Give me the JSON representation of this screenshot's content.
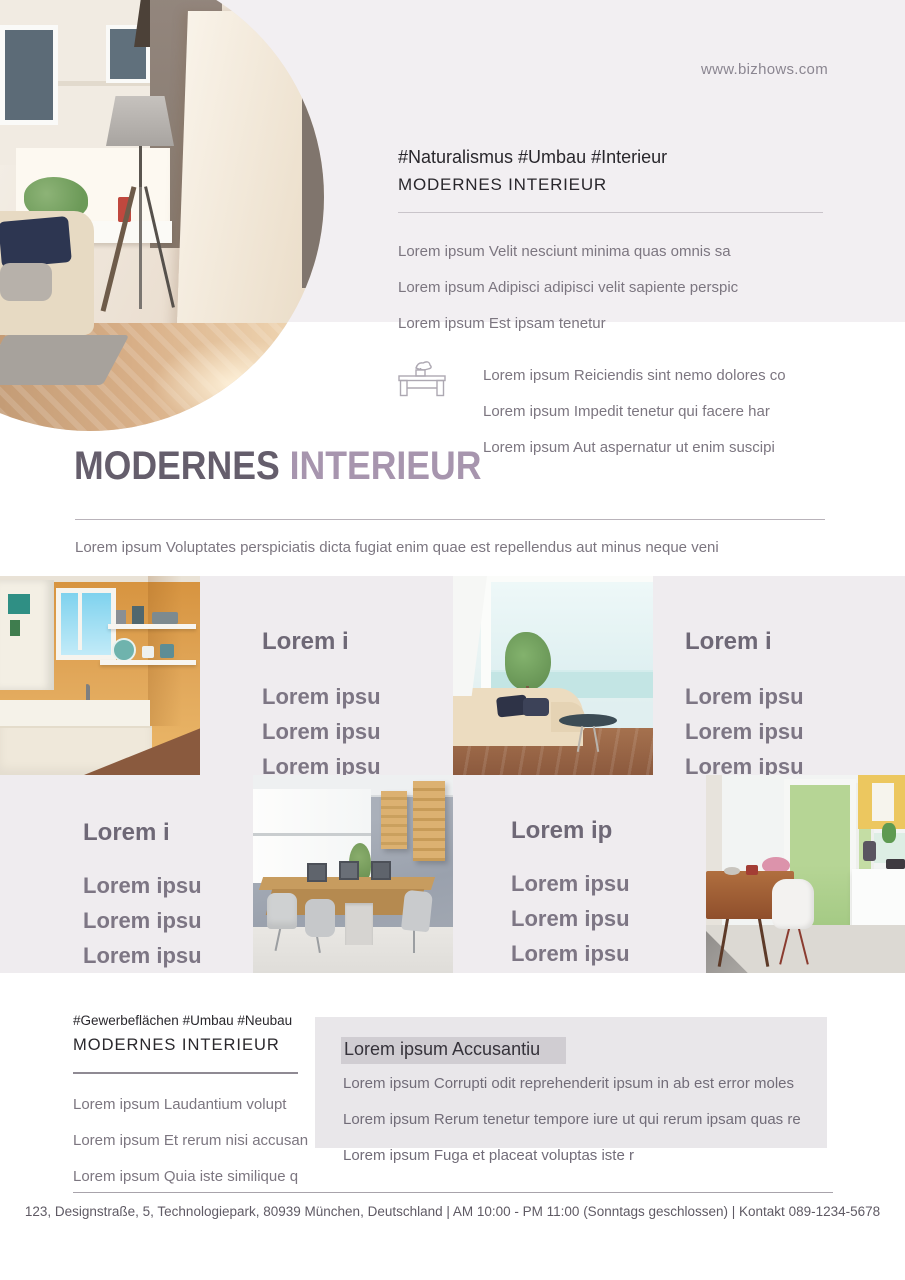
{
  "site": {
    "url": "www.bizhows.com"
  },
  "header": {
    "hashtags": "#Naturalismus #Umbau #Interieur",
    "title": "MODERNES INTERIEUR",
    "intro": [
      "Lorem ipsum Velit nesciunt minima quas omnis sa",
      "Lorem ipsum Adipisci adipisci velit sapiente perspic",
      "Lorem ipsum Est ipsam tenetur"
    ],
    "features": [
      "Lorem ipsum Reiciendis sint nemo dolores co",
      "Lorem ipsum Impedit tenetur qui facere har",
      "Lorem ipsum Aut aspernatur ut enim suscipi"
    ]
  },
  "hero": {
    "title_dark": "MODERNES",
    "title_light": "INTERIEUR",
    "subtitle": "Lorem ipsum Voluptates perspiciatis dicta fugiat enim quae est repellendus aut minus neque veni"
  },
  "grid": {
    "blocks": [
      {
        "heading": "Lorem i",
        "items": [
          "Lorem ipsu",
          "Lorem ipsu",
          "Lorem ipsu"
        ]
      },
      {
        "heading": "Lorem i",
        "items": [
          "Lorem ipsu",
          "Lorem ipsu",
          "Lorem ipsu"
        ]
      },
      {
        "heading": "Lorem i",
        "items": [
          "Lorem ipsu",
          "Lorem ipsu",
          "Lorem ipsu"
        ]
      },
      {
        "heading": "Lorem ip",
        "items": [
          "Lorem ipsu",
          "Lorem ipsu",
          "Lorem ipsu"
        ]
      }
    ]
  },
  "bottom": {
    "hashtags": "#Gewerbeflächen #Umbau #Neubau",
    "title": "MODERNES INTERIEUR",
    "items": [
      "Lorem ipsum Laudantium volupt",
      "Lorem ipsum Et rerum nisi accusan",
      "Lorem ipsum Quia iste similique q"
    ],
    "panel": {
      "heading": "Lorem ipsum Accusantiu",
      "lines": [
        "Lorem ipsum Corrupti odit reprehenderit ipsum in ab est error moles",
        "Lorem ipsum Rerum tenetur tempore iure ut qui rerum ipsam quas re",
        "Lorem ipsum Fuga et placeat voluptas iste r"
      ]
    }
  },
  "footer": {
    "text": "123, Designstraße, 5, Technologiepark, 80939 München, Deutschland | AM 10:00 - PM 11:00 (Sonntags geschlossen) | Kontakt 089-1234-5678"
  },
  "icons": {
    "feature": "console-table-icon"
  },
  "colors": {
    "top_band": "#f2eff2",
    "grid_band": "#efecef",
    "panel_bg": "#e9e7ea",
    "highlight": "#d0cdd2",
    "title_dark": "#655e6c",
    "title_light": "#a795ae",
    "text_gray": "#7c7680",
    "text_dark": "#29272c"
  }
}
